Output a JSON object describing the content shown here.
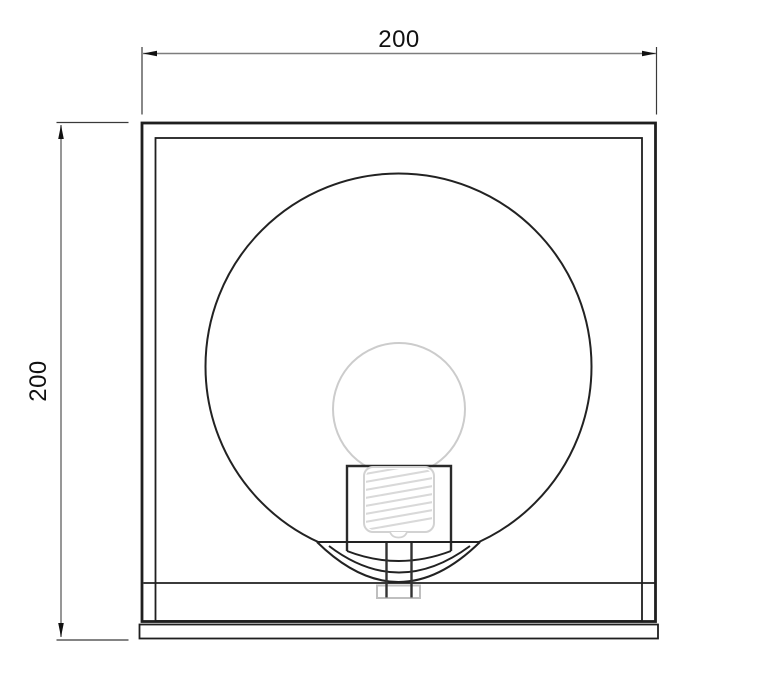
{
  "drawing": {
    "kind": "technical-dimension-drawing",
    "subject": "square-lamp-front-view",
    "dimensions": {
      "width_label": "200",
      "height_label": "200"
    },
    "colors": {
      "background": "#ffffff",
      "outline": "#1f1f1f",
      "dimension_line": "#7d7d7d",
      "extension_line": "#3a3a3a",
      "arrow": "#111111",
      "light_detail": "#d2d2d2",
      "nut_detail": "#bfbfbf"
    }
  }
}
